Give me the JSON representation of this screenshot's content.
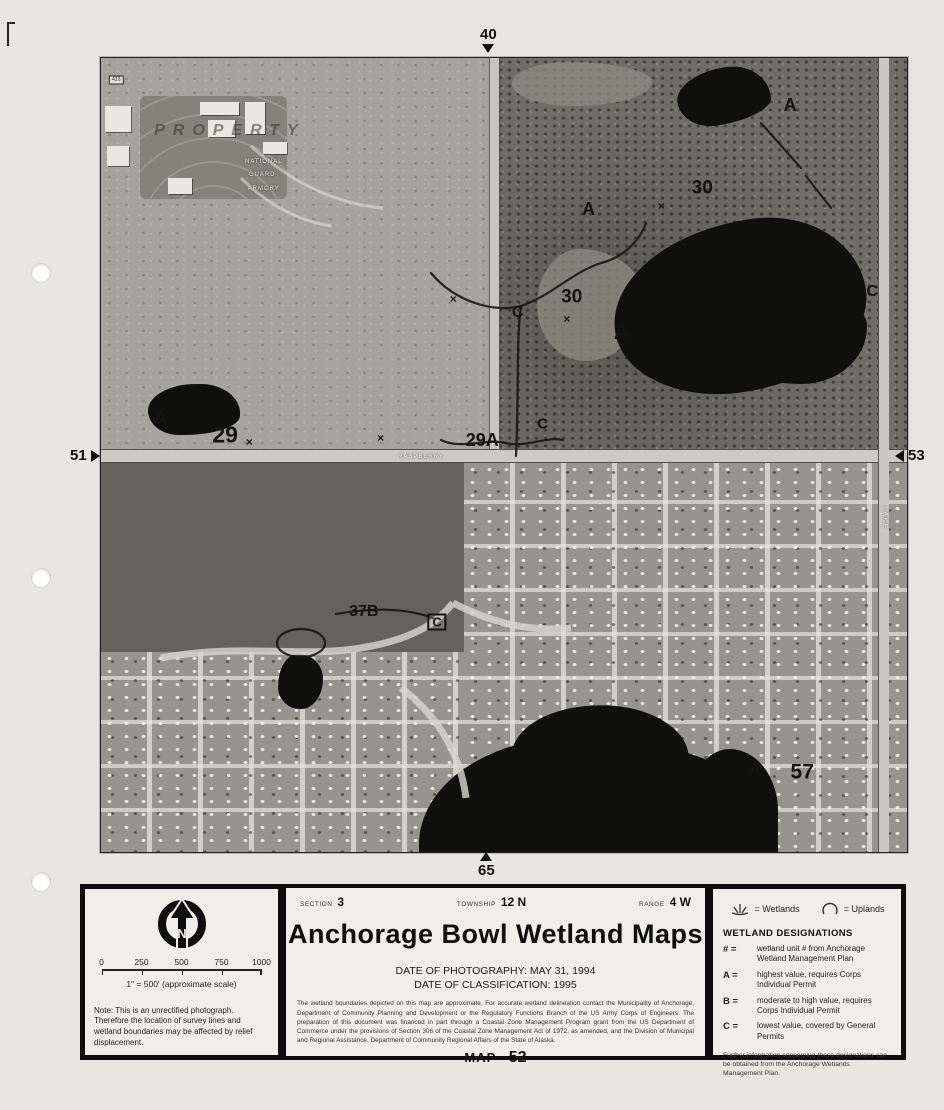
{
  "edge_markers": {
    "top": "40",
    "left": "51",
    "right": "53",
    "bottom": "65"
  },
  "photo": {
    "annotations": [
      {
        "t": "413",
        "x": 1.9,
        "y": 2.8,
        "cls": "tag"
      },
      {
        "t": "PROPERTY",
        "x": 16.0,
        "y": 9.2,
        "cls": "property"
      },
      {
        "t": "NATIONAL",
        "x": 20.2,
        "y": 13.1,
        "cls": "tinywhite"
      },
      {
        "t": "GUARD",
        "x": 20.0,
        "y": 14.7,
        "cls": "tinywhite"
      },
      {
        "t": "ARMORY",
        "x": 20.2,
        "y": 16.5,
        "cls": "tinywhite"
      },
      {
        "t": "A",
        "x": 7.4,
        "y": 45.3,
        "s": 19
      },
      {
        "t": "29",
        "x": 15.4,
        "y": 47.5,
        "s": 23
      },
      {
        "t": "×",
        "x": 18.4,
        "y": 48.4,
        "cls": "xmark",
        "s": 12
      },
      {
        "t": "×",
        "x": 34.7,
        "y": 47.9,
        "cls": "xmark",
        "s": 12
      },
      {
        "t": "29A",
        "x": 47.3,
        "y": 48.1,
        "s": 18
      },
      {
        "t": "C",
        "x": 54.8,
        "y": 46.1,
        "s": 15
      },
      {
        "t": "C",
        "x": 51.7,
        "y": 32.1,
        "s": 16
      },
      {
        "t": "×",
        "x": 43.7,
        "y": 30.4,
        "cls": "xmark",
        "s": 12
      },
      {
        "t": "30",
        "x": 58.4,
        "y": 30.1,
        "s": 19
      },
      {
        "t": "×",
        "x": 57.8,
        "y": 32.9,
        "cls": "xmark",
        "s": 12
      },
      {
        "t": "A",
        "x": 64.6,
        "y": 34.5,
        "s": 22
      },
      {
        "t": "A",
        "x": 60.5,
        "y": 19.0,
        "s": 18
      },
      {
        "t": "30",
        "x": 74.6,
        "y": 16.4,
        "s": 19
      },
      {
        "t": "×",
        "x": 69.5,
        "y": 18.6,
        "cls": "xmark",
        "s": 12
      },
      {
        "t": "A",
        "x": 85.5,
        "y": 5.9,
        "s": 18
      },
      {
        "t": "C",
        "x": 95.7,
        "y": 29.5,
        "s": 16
      },
      {
        "t": "RASPBERRY",
        "x": 39.7,
        "y": 50.2,
        "cls": "tinywhite"
      },
      {
        "t": "LAKE",
        "x": 97.2,
        "y": 57.9,
        "cls": "tinywhite rot"
      },
      {
        "t": "37B",
        "x": 32.6,
        "y": 69.8,
        "s": 16
      },
      {
        "t": "C",
        "x": 41.7,
        "y": 71.0,
        "cls": "boxed",
        "s": 13
      },
      {
        "t": "A",
        "x": 81.1,
        "y": 89.7,
        "s": 18
      },
      {
        "t": "57",
        "x": 87.0,
        "y": 89.9,
        "s": 21
      }
    ]
  },
  "info_panel": {
    "left": {
      "north_label": "N",
      "scale_ticks": [
        "0",
        "250",
        "500",
        "750",
        "1000"
      ],
      "scale_caption": "1\" = 500' (approximate scale)",
      "note": "Note:  This is an unrectified photograph.  Therefore the location of survey lines and wetland boundaries may be affected by relief displacement."
    },
    "center": {
      "section_label": "SECTION",
      "section_value": "3",
      "township_label": "TOWNSHIP",
      "township_value": "12 N",
      "range_label": "RANGE",
      "range_value": "4 W",
      "title": "Anchorage Bowl Wetland Maps",
      "date_photography": "DATE OF PHOTOGRAPHY:  MAY 31, 1994",
      "date_classification": "DATE OF CLASSIFICATION:  1995",
      "disclaimer": "The wetland boundaries depicted on this map are approximate.  For accurate wetland delineation contact the Municipality of Anchorage, Department of Community Planning and Development or the Regulatory Functions Branch of the US Army Corps of Engineers.  The preparation of this document was financed in part through a Coastal Zone Management Program grant from the US Department of Commerce under the provisions of Section 306 of the Coastal Zone Management Act of 1972, as amended, and the Division of Municipal and Regional Assistance, Department of Community Regional Affairs of the State of Alaska.",
      "map_label": "MAP",
      "map_value": "52"
    },
    "right": {
      "wetlands_label": "= Wetlands",
      "uplands_label": "= Uplands",
      "designations_title": "WETLAND DESIGNATIONS",
      "designations": [
        {
          "symbol": "# =",
          "text": "wetland unit # from Anchorage Wetland Management Plan"
        },
        {
          "symbol": "A =",
          "text": "highest value, requires Corps Individual Permit"
        },
        {
          "symbol": "B =",
          "text": "moderate to high value, requires Corps Individual Permit"
        },
        {
          "symbol": "C =",
          "text": "lowest value, covered by General Permits"
        }
      ],
      "footer": "Further information concerning these designations can be obtained from the Anchorage Wetlands Management Plan."
    }
  }
}
